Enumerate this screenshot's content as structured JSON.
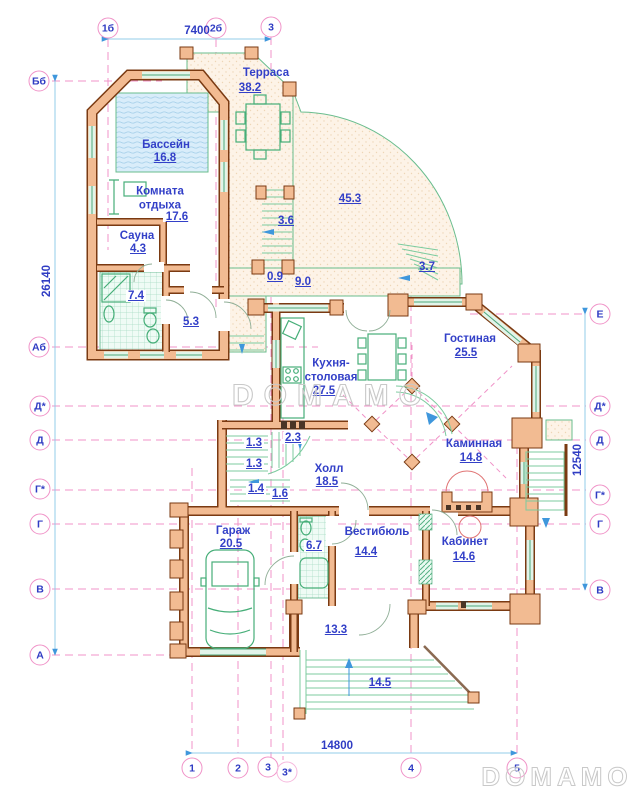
{
  "watermark": {
    "center": "DOMAMO",
    "corner": "DOMAMO"
  },
  "dimensions": {
    "top": "7400",
    "left": "26140",
    "right": "12540",
    "bottom": "14800"
  },
  "axes": {
    "top": [
      {
        "label": "1б"
      },
      {
        "label": "2б"
      },
      {
        "label": "3"
      }
    ],
    "bottom": [
      {
        "label": "1"
      },
      {
        "label": "2"
      },
      {
        "label": "3"
      },
      {
        "label": "3*"
      },
      {
        "label": "4"
      },
      {
        "label": "5"
      }
    ],
    "left": [
      {
        "label": "Бб"
      },
      {
        "label": "Аб"
      },
      {
        "label": "Д*"
      },
      {
        "label": "Д"
      },
      {
        "label": "Г*"
      },
      {
        "label": "Г"
      },
      {
        "label": "В"
      },
      {
        "label": "А"
      }
    ],
    "right": [
      {
        "label": "Е"
      },
      {
        "label": "Д*"
      },
      {
        "label": "Д"
      },
      {
        "label": "Г*"
      },
      {
        "label": "Г"
      },
      {
        "label": "В"
      }
    ]
  },
  "rooms": [
    {
      "name": "Терраса",
      "area": "38.2"
    },
    {
      "name": "Бассейн",
      "area": "16.8"
    },
    {
      "name": "Комната\nотдыха",
      "area": "17.6"
    },
    {
      "name": "Сауна",
      "area": "4.3"
    },
    {
      "name": "Кухня-\nстоловая",
      "area": "27.5"
    },
    {
      "name": "Гостиная",
      "area": "25.5"
    },
    {
      "name": "Каминная",
      "area": "14.8"
    },
    {
      "name": "Холл",
      "area": "18.5"
    },
    {
      "name": "Гараж",
      "area": "20.5"
    },
    {
      "name": "Вестибюль",
      "area": "14.4"
    },
    {
      "name": "Кабинет",
      "area": "14.6"
    }
  ],
  "areas": {
    "terrace_large": "45.3",
    "steps_left": "3.6",
    "steps_right": "3.7",
    "walk_width": "0.9",
    "walk_length": "9.0",
    "bath_main": "7.4",
    "room_53": "5.3",
    "stair_13a": "1.3",
    "stair_23": "2.3",
    "stair_13b": "1.3",
    "stair_14": "1.4",
    "stair_16": "1.6",
    "bath_67": "6.7",
    "porch": "13.3",
    "entry_steps": "14.5"
  },
  "colors": {
    "wall_fill": "#f2bb92",
    "wall_outline": "#7a3a12",
    "label_blue": "#3340c8",
    "axis_pink": "#f093c8",
    "dim_blue": "#93cce9",
    "furniture_green": "#46ae78",
    "pool_blue": "#d9edfa",
    "terrace_fill": "#fdf3e7",
    "watermark_gray": "#c9c9c9"
  }
}
